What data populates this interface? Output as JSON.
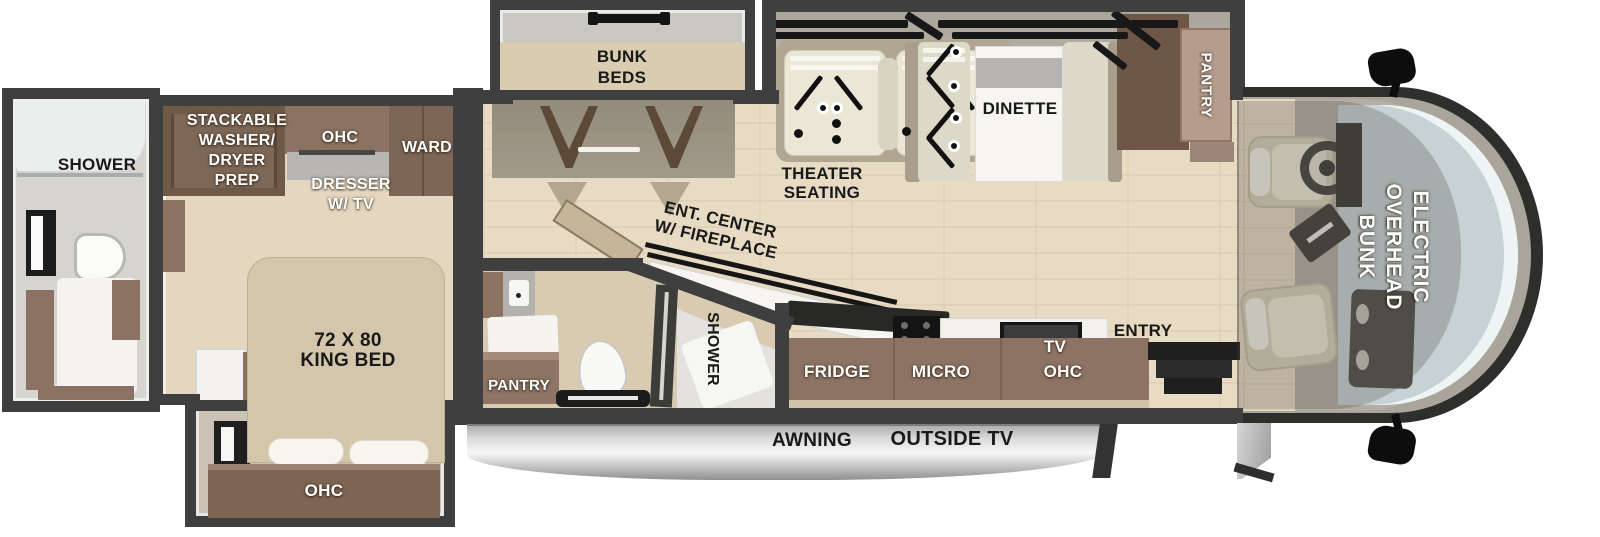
{
  "title": "Class A motorhome floor plan",
  "palette": {
    "wall": "#3f3f3f",
    "floor_wood": "#e8dbc3",
    "slide_floor": "#b9b5aa",
    "cabinet_brown": "#8d7363",
    "cabinet_dark": "#6e5746",
    "bed_tan": "#d3c6aa",
    "seat_cream": "#eae7d7",
    "marble_white": "#f5f4f1",
    "windshield_glass": "#c7d2d4",
    "awning_silver": "#d9d9d9",
    "label_black": "#191919",
    "label_white": "#ffffff"
  },
  "rooms": {
    "rear_bath": {
      "shower": "SHOWER"
    },
    "bedroom": {
      "washer_prep": [
        "STACKABLE",
        "WASHER/",
        "DRYER",
        "PREP"
      ],
      "ohc": "OHC",
      "ward": "WARD",
      "dresser": [
        "DRESSER",
        "W/ TV"
      ],
      "king_bed": [
        "72 X 80",
        "KING BED"
      ],
      "slide_ohc": "OHC"
    },
    "bunk_room": {
      "bunk_beds": [
        "BUNK",
        "BEDS"
      ]
    },
    "living": {
      "theater": [
        "THEATER",
        "SEATING"
      ],
      "dinette": "DINETTE",
      "pantry": "PANTRY",
      "ent_center": [
        "ENT. CENTER",
        "W/ FIREPLACE"
      ]
    },
    "mid_bath": {
      "shower": "SHOWER",
      "pantry": "PANTRY"
    },
    "kitchen": {
      "fridge": "FRIDGE",
      "micro": "MICRO",
      "tv": "TV",
      "ohc": "OHC",
      "entry": "ENTRY"
    },
    "cab": {
      "overhead_bunk": [
        "ELECTRIC",
        "OVERHEAD",
        "BUNK"
      ]
    },
    "exterior": {
      "awning": "AWNING",
      "outside_tv": "OUTSIDE TV"
    }
  }
}
